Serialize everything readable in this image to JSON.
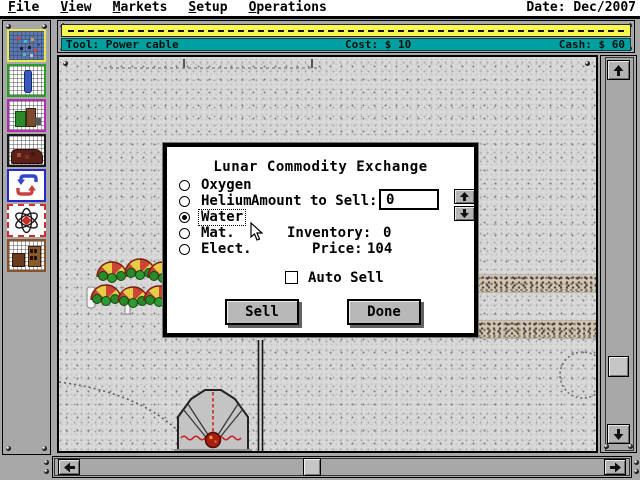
{
  "menu_bar": {
    "items": [
      {
        "label": "File"
      },
      {
        "label": "View"
      },
      {
        "label": "Markets"
      },
      {
        "label": "Setup"
      },
      {
        "label": "Operations"
      }
    ],
    "date": "Date: Dec/2007"
  },
  "tool_bar": {
    "tool": "Tool: Power cable",
    "cost": "Cost: $ 10",
    "cash": "Cash: $ 60"
  },
  "sidebar": {
    "tools": [
      {
        "name": "colony-map-tool"
      },
      {
        "name": "tube-build-tool"
      },
      {
        "name": "habitat-build-tool"
      },
      {
        "name": "mine-build-tool"
      },
      {
        "name": "recycle-tool"
      },
      {
        "name": "reactor-tool"
      },
      {
        "name": "factory-build-tool"
      }
    ]
  },
  "dialog": {
    "title": "Lunar Commodity Exchange",
    "commodities": [
      {
        "label": "Oxygen",
        "selected": false
      },
      {
        "label": "Helium",
        "selected": false
      },
      {
        "label": "Water",
        "selected": true
      },
      {
        "label": "Mat.",
        "selected": false
      },
      {
        "label": "Elect.",
        "selected": false
      }
    ],
    "amount": {
      "label": "Amount to Sell:",
      "value": "0"
    },
    "inventory": {
      "label": "Inventory:",
      "value": "0"
    },
    "price": {
      "label": "Price:",
      "value": "104"
    },
    "auto_sell": {
      "label": "Auto Sell",
      "checked": false
    },
    "buttons": {
      "sell": "Sell",
      "done": "Done"
    }
  },
  "colors": {
    "teal_bar": "#00A0A0",
    "yellow_bar": "#F8F850",
    "panel_gray": "#A8A8A8",
    "terrain": "#D9D9D9"
  }
}
